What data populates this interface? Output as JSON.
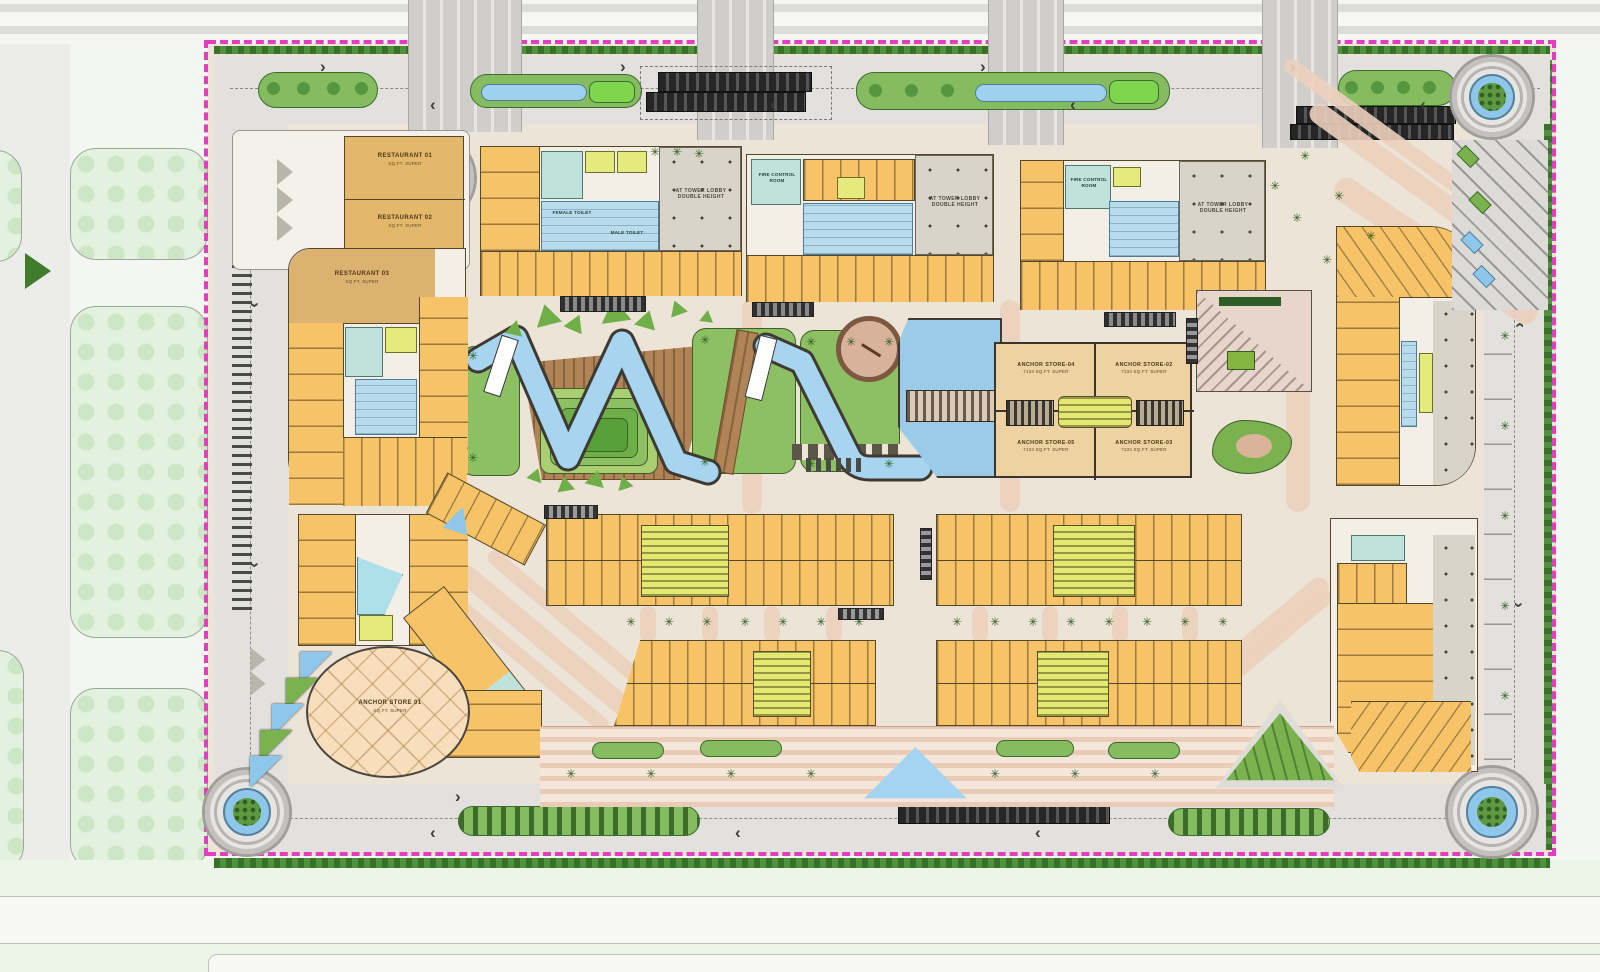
{
  "title": "Retail development ground-floor master plan",
  "labels": {
    "restaurant_01": {
      "name": "RESTAURANT 01",
      "area": "SQ.FT. SUPER"
    },
    "restaurant_02": {
      "name": "RESTAURANT 02",
      "area": "SQ.FT. SUPER"
    },
    "restaurant_03": {
      "name": "RESTAURANT 03",
      "area": "SQ.FT. SUPER"
    },
    "fire_control_room": "FIRE CONTROL ROOM",
    "tower_lobby": {
      "l1": "AT TOWER LOBBY",
      "l2": "DOUBLE HEIGHT"
    },
    "female_toilet": "FEMALE TOILET",
    "male_toilet": "MALE TOILET",
    "anchor_store_01": {
      "name": "ANCHOR STORE 01",
      "area": "SQ.FT. SUPER"
    },
    "anchor_store_02": {
      "name": "ANCHOR STORE-02",
      "area": "7134 SQ.FT. SUPER"
    },
    "anchor_store_03": {
      "name": "ANCHOR STORE-03",
      "area": "7134 SQ.FT. SUPER"
    },
    "anchor_store_04": {
      "name": "ANCHOR STORE-04",
      "area": "7134 SQ.FT. SUPER"
    },
    "anchor_store_05": {
      "name": "ANCHOR STORE-05",
      "area": "7134 SQ.FT. SUPER"
    }
  },
  "colors": {
    "site_background": "#ece4d6",
    "retail_unit": "#f6c368",
    "anchor_fill": "#eed2a2",
    "toilet_blue": "#b9dcec",
    "fire_room_teal": "#bfe2da",
    "lift_core": "#e4ea7d",
    "lobby_grey": "#d9d4ca",
    "water": "#9fd0ee",
    "lawn": "#8cc063",
    "deck_wood": "#b08457",
    "boundary_magenta": "#e23fc0",
    "road": "#e2e1dd",
    "promenade_pink": "#e9cbb8"
  }
}
